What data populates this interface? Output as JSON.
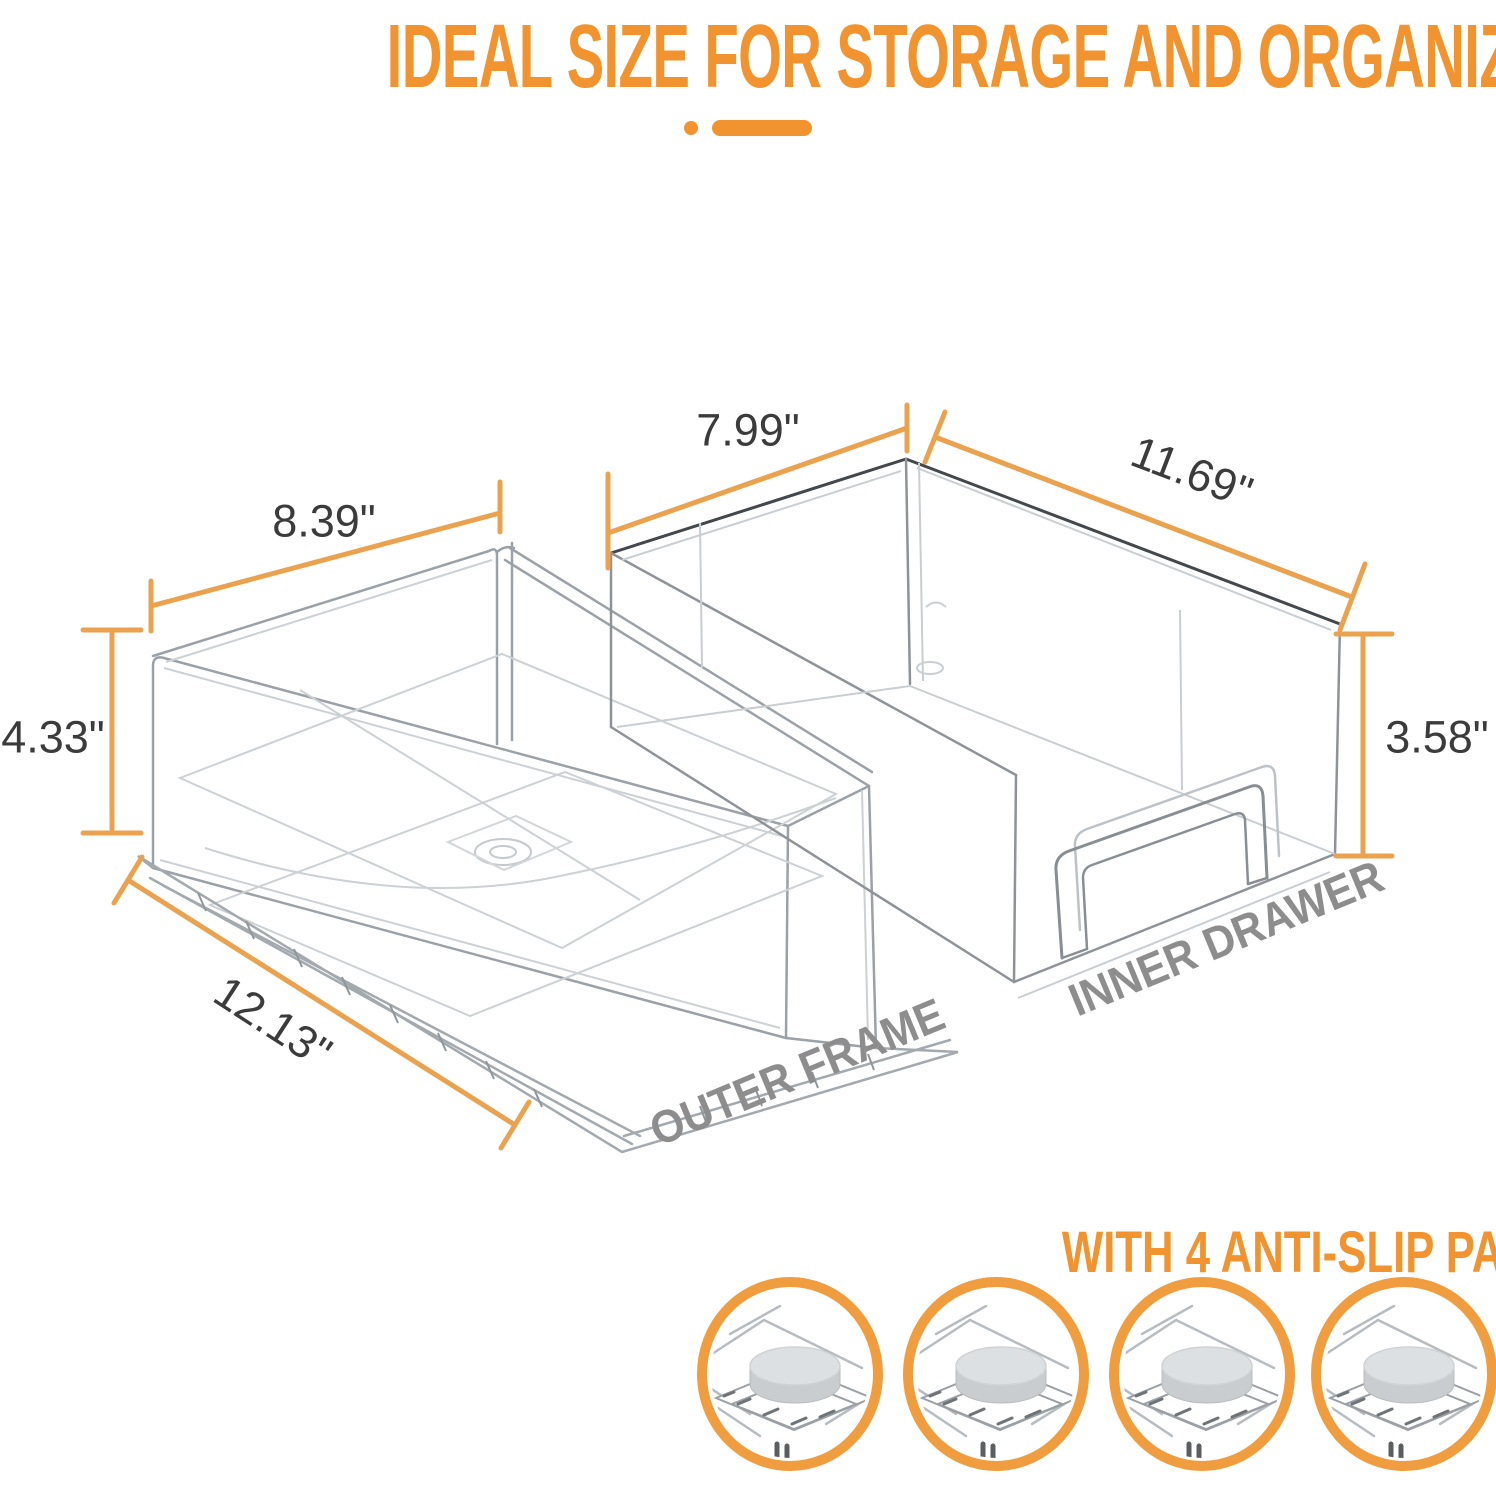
{
  "title": "IDEAL SIZE FOR STORAGE AND ORGANIZATION",
  "diagram": {
    "parts": [
      {
        "label": "OUTER FRAME",
        "dimensions": {
          "width": "8.39\"",
          "height": "4.33\"",
          "depth": "12.13\""
        }
      },
      {
        "label": "INNER DRAWER",
        "dimensions": {
          "width": "7.99\"",
          "height": "3.58\"",
          "depth": "11.69\""
        }
      }
    ]
  },
  "pads_section": {
    "heading": "WITH 4 ANTI-SLIP PADS",
    "pad_count": 4
  },
  "colors": {
    "accent_orange": "#F1932E",
    "dimension_line_orange": "#EBA24F",
    "pad_ring_orange": "#EF9D3E",
    "label_gray": "#8D8D8D",
    "dimension_text": "#3B3B3B",
    "line_art_gray": "#9AA1A8",
    "background": "#FFFFFF"
  }
}
